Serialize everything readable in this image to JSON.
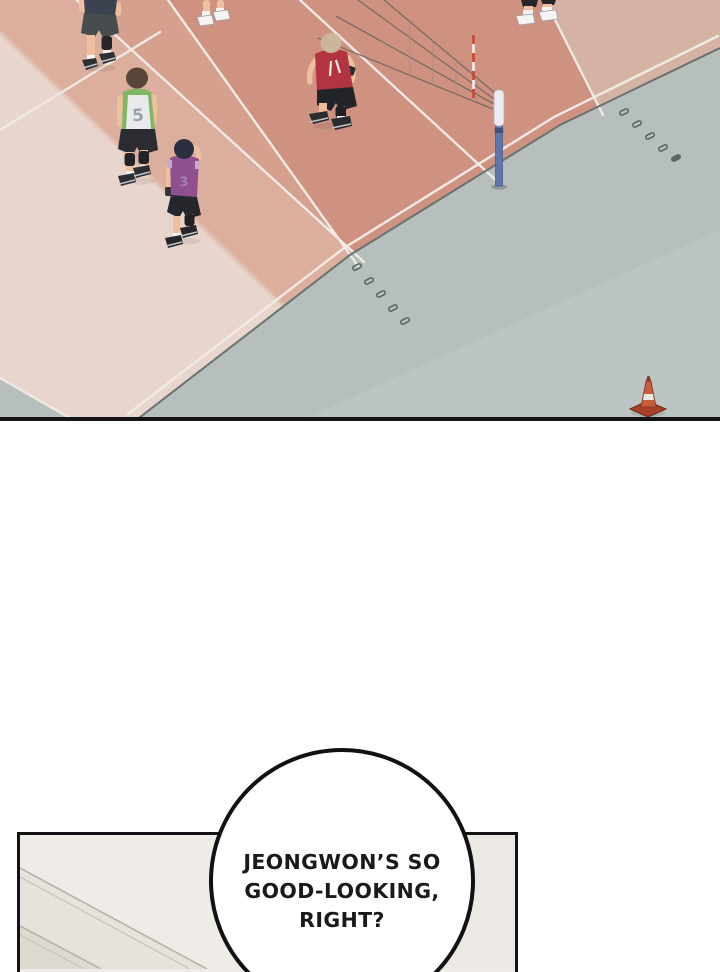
{
  "scene": {
    "description": "volleyball gym practice viewed from above",
    "players": {
      "green": {
        "label": "green-jersey-player",
        "jersey_number": "5",
        "jersey_color": "#7fb763"
      },
      "purple": {
        "label": "purple-jersey-player",
        "jersey_number": "3",
        "jersey_color": "#8f4f90"
      },
      "red": {
        "label": "red-jersey-player",
        "jersey_color": "#b23440"
      },
      "dark": {
        "label": "dark-jersey-player",
        "jersey_color": "#3a434f"
      }
    }
  },
  "speech_bubble": {
    "lines": [
      "JEONGWON’S SO",
      "GOOD-LOOKING,",
      "RIGHT?"
    ]
  },
  "colors": {
    "court_salmon": "#cf9180",
    "court_mid_strip": "#d5a08e",
    "court_peach_strip": "#dcae9d",
    "court_beige": "#e8d6ce",
    "court_right_light": "#d4b2a4",
    "floor_gray": "#b7bfbd",
    "floor_gray_light": "#c3cbc8",
    "court_line_white": "#f0eae5",
    "floor_edge_dark": "#68726f",
    "net_post_blue": "#5c77aa",
    "cone_orange": "#c75c3c",
    "room_wall": "#efece7",
    "panel_border": "#141414",
    "bubble_text": "#1a1a1a"
  }
}
